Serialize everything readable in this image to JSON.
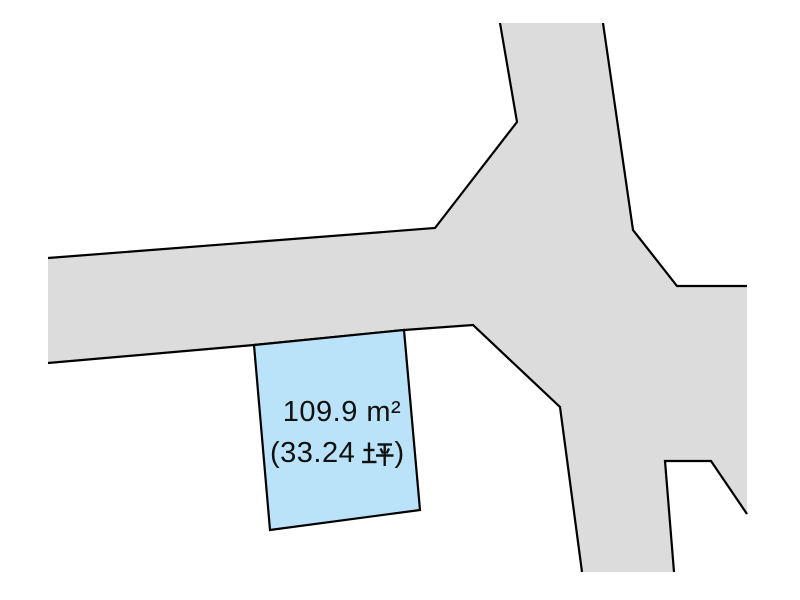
{
  "map": {
    "background_color": "#ffffff",
    "road": {
      "fill_color": "#dcdcdc",
      "stroke_color": "#000000",
      "fill_points": "500,23 603,23 633,230 677,286 747,286 747,514 711,461 665,461 674,572 582,572 560,407 473,325 404,330 254,345 48,363 48,258 435,228 517,122",
      "edge_paths": [
        "M500,23 L517,122 L435,228 L48,258",
        "M48,363 L254,345 L404,330 L473,325 L560,407 L582,572",
        "M603,23 L633,230 L677,286 L747,286",
        "M674,572 L665,461 L711,461 L747,514"
      ]
    },
    "parcel": {
      "fill_color": "#bae2f8",
      "stroke_color": "#000000",
      "points": "254,345 404,330 420,510 270,530",
      "area_sqm": "109.9 m²",
      "area_tsubo_open": "(33.24",
      "area_tsubo_unit": "坪",
      "area_tsubo_close": ")"
    }
  }
}
